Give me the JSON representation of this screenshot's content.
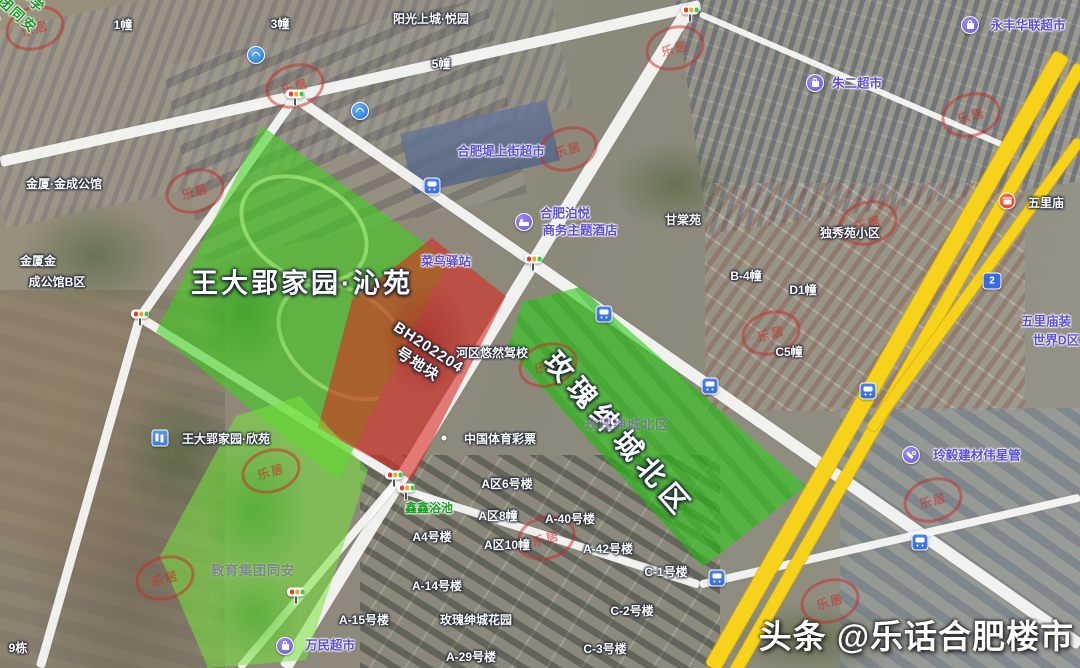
{
  "map": {
    "region_overlays": {
      "qinyuan": {
        "label": "王大郢家园·沁苑",
        "color": "#3ed21c"
      },
      "plot_bh202204": {
        "lines": [
          "BH202204",
          "号地块"
        ],
        "color": "#da2a22"
      },
      "meigui_north": {
        "label": "玫瑰绅城北区",
        "color": "#2fcd19"
      },
      "tunxi_school": {
        "lines": [
          "屯溪路小学",
          "教育集团同安",
          "校区"
        ],
        "color": "#76e43a",
        "text_color": "#129a1d"
      }
    },
    "labels": [
      {
        "n": "label-building-1",
        "t": "1幢",
        "x": 123,
        "y": 25,
        "k": "w"
      },
      {
        "n": "label-building-3",
        "t": "3幢",
        "x": 280,
        "y": 24,
        "k": "w"
      },
      {
        "n": "label-yangguang-shangcheng",
        "t": "阳光上城·悦园",
        "x": 431,
        "y": 19,
        "k": "w"
      },
      {
        "n": "label-building-5",
        "t": "5幢",
        "x": 441,
        "y": 64,
        "k": "w"
      },
      {
        "n": "label-yongfeng-hualian-market",
        "t": "永丰华联超市",
        "x": 1028,
        "y": 26,
        "k": "p",
        "it": true
      },
      {
        "n": "label-zhuer-market",
        "t": "朱二超市",
        "x": 857,
        "y": 84,
        "k": "p",
        "it": true
      },
      {
        "n": "label-jinxia-jincheng",
        "t": "金厦·金成公馆",
        "x": 64,
        "y": 184,
        "k": "w"
      },
      {
        "n": "label-dishangjie-market",
        "t": "合肥堤上街超市",
        "x": 501,
        "y": 152,
        "k": "p",
        "it": true
      },
      {
        "n": "label-boyue-hotel-1",
        "t": "合肥泊悦",
        "x": 565,
        "y": 214,
        "k": "p",
        "it": true
      },
      {
        "n": "label-boyue-hotel-2",
        "t": "商务主题酒店",
        "x": 580,
        "y": 231,
        "k": "p",
        "it": true
      },
      {
        "n": "label-gantangyuan",
        "t": "甘棠苑",
        "x": 683,
        "y": 220,
        "k": "w"
      },
      {
        "n": "label-duxiuyuan",
        "t": "独秀苑小区",
        "x": 850,
        "y": 233,
        "k": "w"
      },
      {
        "n": "label-wulimiao",
        "t": "五里庙",
        "x": 1046,
        "y": 203,
        "k": "w"
      },
      {
        "n": "label-jinxia-b-1",
        "t": "金厦金",
        "x": 38,
        "y": 261,
        "k": "w"
      },
      {
        "n": "label-jinxia-b-2",
        "t": "成公馆B区",
        "x": 57,
        "y": 282,
        "k": "w"
      },
      {
        "n": "label-cainiao-station",
        "t": "菜鸟驿站",
        "x": 446,
        "y": 262,
        "k": "p",
        "it": true
      },
      {
        "n": "label-b4",
        "t": "B-4幢",
        "x": 746,
        "y": 276,
        "k": "w"
      },
      {
        "n": "label-d1",
        "t": "D1幢",
        "x": 803,
        "y": 290,
        "k": "w"
      },
      {
        "n": "label-c5",
        "t": "C5幢",
        "x": 789,
        "y": 352,
        "k": "w"
      },
      {
        "n": "label-wulimiao-deco-1",
        "t": "五里庙装",
        "x": 1046,
        "y": 322,
        "k": "p",
        "it": true
      },
      {
        "n": "label-wulimiao-deco-2",
        "t": "世界D区",
        "x": 1056,
        "y": 341,
        "k": "p",
        "it": true
      },
      {
        "n": "label-driving-school",
        "t": "河区悠然驾校",
        "x": 492,
        "y": 353,
        "k": "w"
      },
      {
        "n": "label-meigui-base",
        "t": "玫瑰绅城北区",
        "x": 627,
        "y": 425,
        "k": "f"
      },
      {
        "n": "label-xinyuan",
        "t": "王大郢家园·欣苑",
        "x": 226,
        "y": 439,
        "k": "w"
      },
      {
        "n": "label-sports-lottery",
        "t": "中国体育彩票",
        "x": 500,
        "y": 439,
        "k": "w"
      },
      {
        "n": "label-xinxin-bath",
        "t": "鑫鑫浴池",
        "x": 429,
        "y": 508,
        "k": "g",
        "it": true
      },
      {
        "n": "label-a6",
        "t": "A区6号楼",
        "x": 507,
        "y": 484,
        "k": "w"
      },
      {
        "n": "label-a8",
        "t": "A区8幢",
        "x": 498,
        "y": 516,
        "k": "w"
      },
      {
        "n": "label-a40",
        "t": "A-40号楼",
        "x": 570,
        "y": 519,
        "k": "w"
      },
      {
        "n": "label-a4",
        "t": "A4号楼",
        "x": 432,
        "y": 537,
        "k": "w"
      },
      {
        "n": "label-a10",
        "t": "A区10幢",
        "x": 507,
        "y": 545,
        "k": "w"
      },
      {
        "n": "label-a42",
        "t": "A-42号楼",
        "x": 608,
        "y": 549,
        "k": "w"
      },
      {
        "n": "label-c1",
        "t": "C-1号楼",
        "x": 666,
        "y": 572,
        "k": "w"
      },
      {
        "n": "label-a14",
        "t": "A-14号楼",
        "x": 437,
        "y": 586,
        "k": "w"
      },
      {
        "n": "label-c2",
        "t": "C-2号楼",
        "x": 632,
        "y": 611,
        "k": "w"
      },
      {
        "n": "label-a15",
        "t": "A-15号楼",
        "x": 364,
        "y": 620,
        "k": "w"
      },
      {
        "n": "label-meigui-garden",
        "t": "玫瑰绅城花园",
        "x": 476,
        "y": 620,
        "k": "w"
      },
      {
        "n": "label-c3",
        "t": "C-3号楼",
        "x": 605,
        "y": 649,
        "k": "w"
      },
      {
        "n": "label-a29",
        "t": "A-29号楼",
        "x": 471,
        "y": 657,
        "k": "w"
      },
      {
        "n": "label-building-9",
        "t": "9栋",
        "x": 18,
        "y": 648,
        "k": "w"
      },
      {
        "n": "label-wanmin-market",
        "t": "万民超市",
        "x": 330,
        "y": 646,
        "k": "p",
        "it": true
      },
      {
        "n": "label-lingyi-materials",
        "t": "玲毅建材伟星管",
        "x": 977,
        "y": 456,
        "k": "p",
        "it": true
      },
      {
        "n": "label-school-base-faint",
        "t": "教育集团同安",
        "x": 253,
        "y": 571,
        "k": "f"
      }
    ],
    "icons": [
      {
        "n": "china-mobile-icon",
        "c": "ic-mobile",
        "x": 256,
        "y": 55,
        "it": true
      },
      {
        "n": "china-mobile-icon",
        "c": "ic-mobile",
        "x": 360,
        "y": 111,
        "it": true
      },
      {
        "n": "traffic-light-icon",
        "c": "ic-tl",
        "x": 295,
        "y": 94
      },
      {
        "n": "traffic-light-icon",
        "c": "ic-tl",
        "x": 533,
        "y": 259
      },
      {
        "n": "traffic-light-icon",
        "c": "ic-tl",
        "x": 690,
        "y": 10
      },
      {
        "n": "traffic-light-icon",
        "c": "ic-tl",
        "x": 140,
        "y": 314
      },
      {
        "n": "traffic-light-icon",
        "c": "ic-tl",
        "x": 394,
        "y": 475
      },
      {
        "n": "traffic-light-icon",
        "c": "ic-tl",
        "x": 406,
        "y": 488
      },
      {
        "n": "traffic-light-icon",
        "c": "ic-tl",
        "x": 296,
        "y": 592
      },
      {
        "n": "bus-stop-icon",
        "c": "ic-bus",
        "x": 432,
        "y": 186,
        "it": true
      },
      {
        "n": "bus-stop-icon",
        "c": "ic-bus",
        "x": 604,
        "y": 314,
        "it": true
      },
      {
        "n": "bus-stop-icon",
        "c": "ic-bus",
        "x": 710,
        "y": 386,
        "it": true
      },
      {
        "n": "bus-stop-icon",
        "c": "ic-bus",
        "x": 868,
        "y": 391,
        "it": true
      },
      {
        "n": "bus-stop-icon",
        "c": "ic-bus",
        "x": 717,
        "y": 578,
        "it": true
      },
      {
        "n": "bus-stop-icon",
        "c": "ic-bus",
        "x": 920,
        "y": 542,
        "it": true
      },
      {
        "n": "supermarket-poi-icon",
        "c": "ic-shop",
        "x": 970,
        "y": 25,
        "it": true
      },
      {
        "n": "supermarket-poi-icon",
        "c": "ic-shop",
        "x": 815,
        "y": 83,
        "it": true
      },
      {
        "n": "supermarket-poi-icon",
        "c": "ic-shop",
        "x": 285,
        "y": 646,
        "it": true
      },
      {
        "n": "hotel-poi-icon",
        "c": "ic-hotel",
        "x": 524,
        "y": 222,
        "it": true
      },
      {
        "n": "hardware-poi-icon",
        "c": "ic-hw",
        "x": 911,
        "y": 455,
        "it": true
      },
      {
        "n": "temple-poi-icon",
        "c": "ic-temple",
        "x": 1007,
        "y": 201,
        "it": true
      },
      {
        "n": "residential-poi-icon",
        "c": "ic-bldg",
        "x": 160,
        "y": 438,
        "it": true
      },
      {
        "n": "poi-dot-icon",
        "c": "ic-dot",
        "x": 444,
        "y": 438
      },
      {
        "n": "highway-shield-icon",
        "c": "ic-shield",
        "x": 992,
        "y": 281,
        "text": "2"
      }
    ],
    "stamps": {
      "text": "乐居",
      "positions": [
        {
          "x": 32,
          "y": 25
        },
        {
          "x": 292,
          "y": 83
        },
        {
          "x": 192,
          "y": 188
        },
        {
          "x": 565,
          "y": 146
        },
        {
          "x": 672,
          "y": 45
        },
        {
          "x": 865,
          "y": 220
        },
        {
          "x": 968,
          "y": 112
        },
        {
          "x": 768,
          "y": 330
        },
        {
          "x": 545,
          "y": 362
        },
        {
          "x": 543,
          "y": 535
        },
        {
          "x": 930,
          "y": 497
        },
        {
          "x": 827,
          "y": 598
        },
        {
          "x": 268,
          "y": 468
        },
        {
          "x": 162,
          "y": 575
        }
      ]
    }
  },
  "watermark": {
    "source": "头条",
    "account": "@乐话合肥楼市"
  }
}
